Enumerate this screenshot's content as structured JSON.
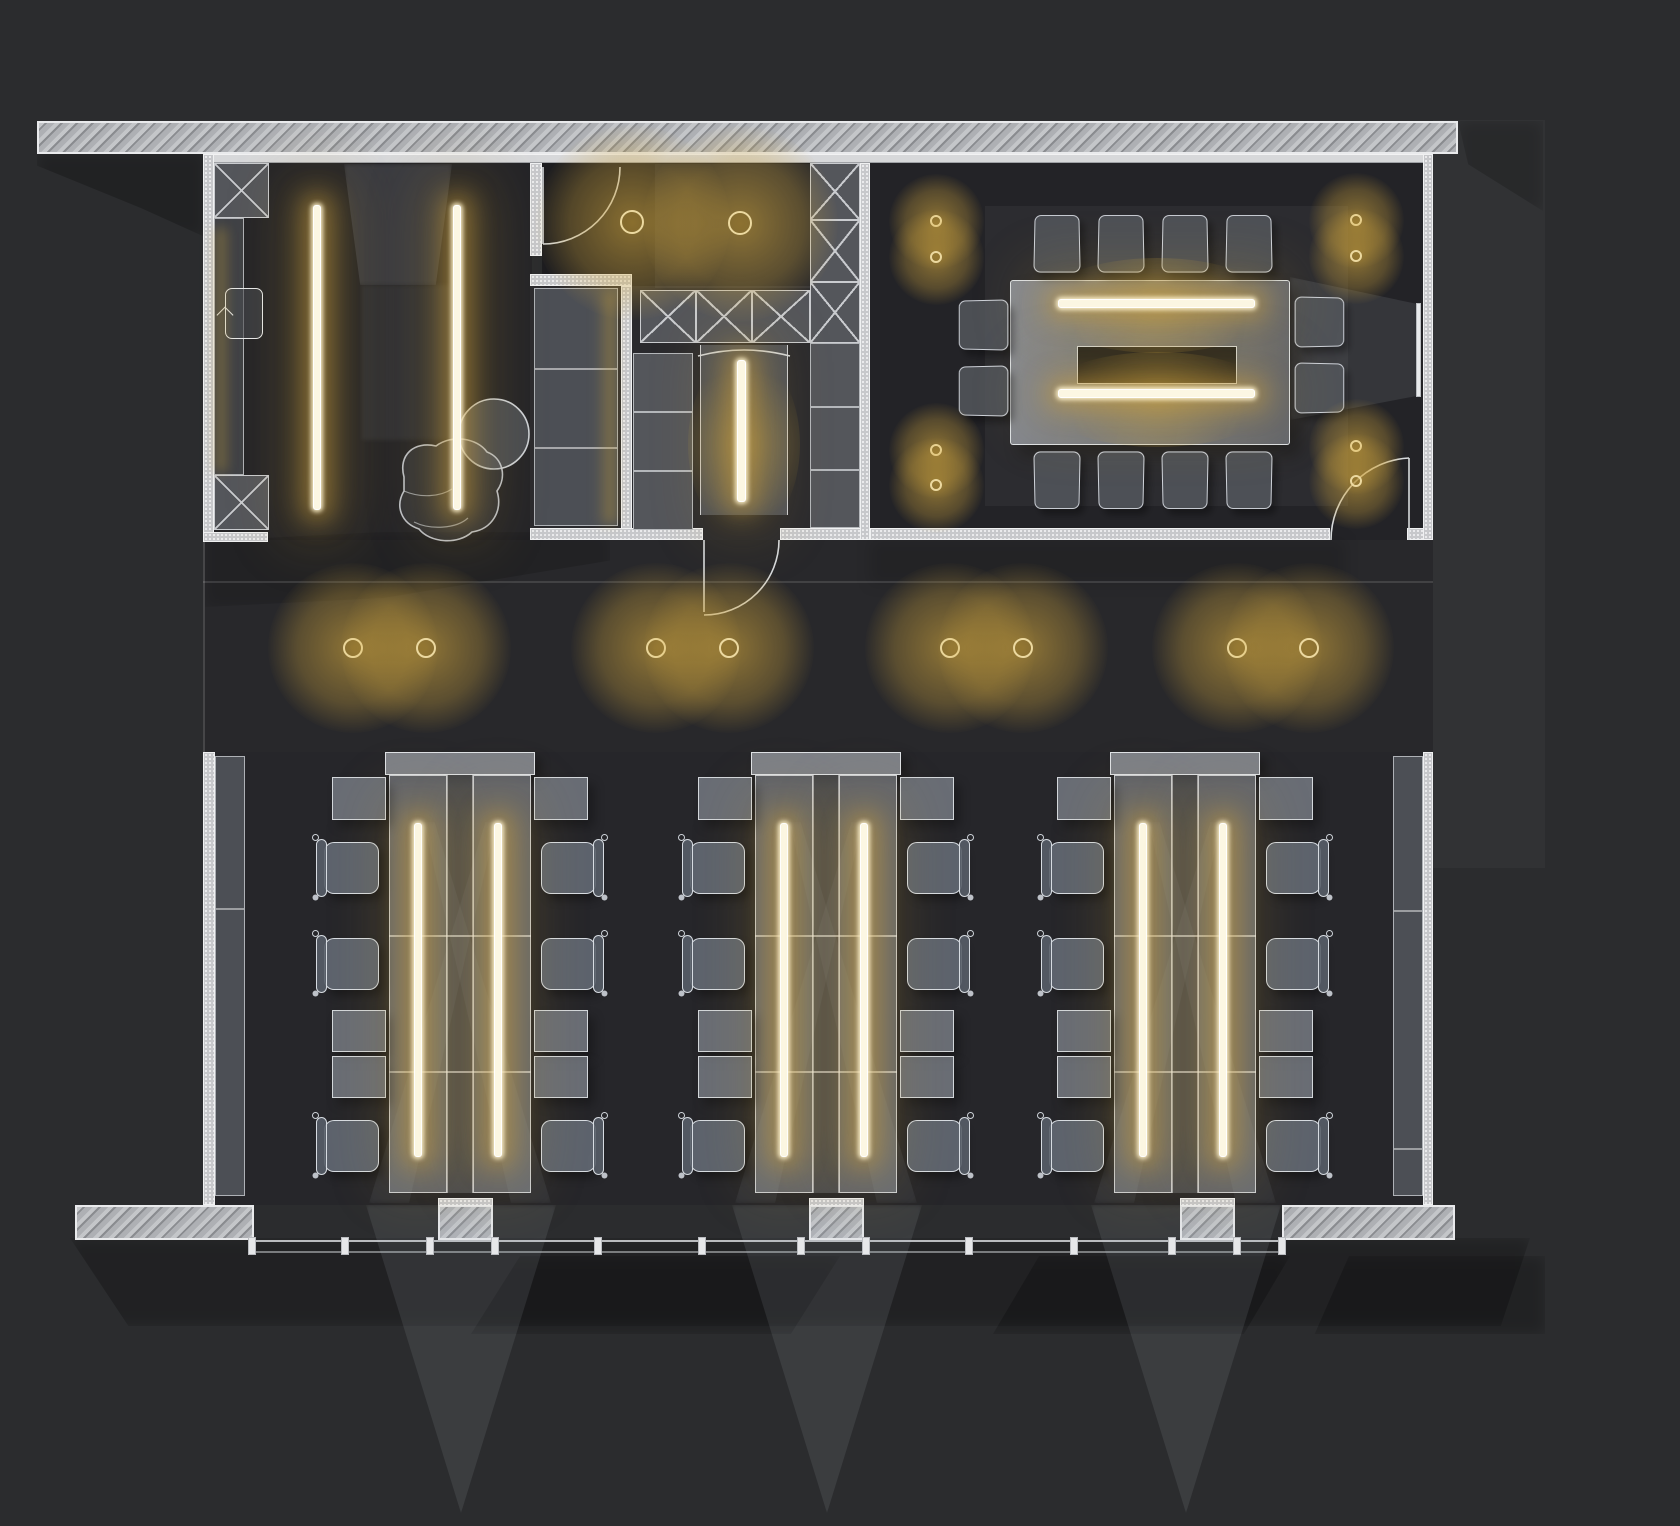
{
  "title": "office-lighting-floor-plan",
  "canvas": {
    "width": 1680,
    "height": 1526,
    "background": "#2b2c2e"
  },
  "palette": {
    "floor": "#242428",
    "floor_dark": "#1d1d20",
    "wall_hatch": "#9b9da1",
    "wall_stipple": "#c7c8cb",
    "wall_edge": "#f0f1f2",
    "furniture_fill": "rgba(172,179,191,0.5)",
    "furniture_line": "#e6eaef",
    "closet_fill": "#54565b",
    "glow_core": "#fcf7e3",
    "glow_warm": "#cfa23e",
    "halo": "rgba(210,167,62,0.6)",
    "beam": "rgba(188,198,214,0.11)",
    "shadow": "rgba(0,0,0,0.22)"
  },
  "lights": {
    "downlights": {
      "corridor": {
        "r": 10,
        "halo": 170,
        "points": [
          [
            353,
            648
          ],
          [
            426,
            648
          ],
          [
            656,
            648
          ],
          [
            729,
            648
          ],
          [
            950,
            648
          ],
          [
            1023,
            648
          ],
          [
            1237,
            648
          ],
          [
            1309,
            648
          ]
        ]
      },
      "vestibule": {
        "r": 12,
        "halo": 195,
        "points": [
          [
            632,
            222
          ],
          [
            740,
            223
          ]
        ]
      },
      "conference": {
        "r": 6,
        "halo": 95,
        "points": [
          [
            936,
            221
          ],
          [
            936,
            257
          ],
          [
            936,
            450
          ],
          [
            936,
            485
          ],
          [
            1356,
            220
          ],
          [
            1356,
            256
          ],
          [
            1356,
            446
          ],
          [
            1356,
            481
          ]
        ]
      }
    },
    "strips": [
      {
        "name": "entry-pendant-1",
        "x": 313,
        "y": 205,
        "w": 8,
        "h": 305
      },
      {
        "name": "entry-pendant-2",
        "x": 453,
        "y": 205,
        "w": 8,
        "h": 305
      },
      {
        "name": "wardrobe-niche-light",
        "x": 737,
        "y": 360,
        "w": 9,
        "h": 142
      },
      {
        "name": "conference-table-light-1",
        "x": 1058,
        "y": 299,
        "w": 197,
        "h": 9
      },
      {
        "name": "conference-table-light-2",
        "x": 1058,
        "y": 389,
        "w": 197,
        "h": 9
      }
    ],
    "edge_glows": [
      {
        "name": "entry-wardrobe-glow",
        "x": 210,
        "y": 228,
        "w": 16,
        "h": 244
      },
      {
        "name": "storage-cabinet-glow",
        "x": 596,
        "y": 292,
        "w": 20,
        "h": 232
      }
    ],
    "warm_washes": [
      {
        "x": 1040,
        "y": 258,
        "w": 235,
        "h": 95
      },
      {
        "x": 1040,
        "y": 352,
        "w": 235,
        "h": 95
      },
      {
        "x": 688,
        "y": 352,
        "w": 112,
        "h": 185
      }
    ]
  },
  "open_office": {
    "bench_xs": [
      389,
      755,
      1114
    ],
    "bench": {
      "y": 752,
      "w": 142,
      "h": 441,
      "cap_h": 23,
      "col_w": 58,
      "light_dx": [
        25,
        105
      ],
      "light_y": 823,
      "light_h": 334,
      "light_w": 8,
      "dividers_dy": [
        160,
        296
      ]
    },
    "side_rects": [
      {
        "dy": 25,
        "h": 43
      },
      {
        "dy": 258,
        "h": 42
      },
      {
        "dy": 304,
        "h": 42
      }
    ],
    "side_chairs": [
      {
        "dy": 90
      },
      {
        "dy": 186
      },
      {
        "dy": 368
      }
    ],
    "chair": {
      "w": 55,
      "h": 52
    },
    "window_beams": [
      [
        366,
        556,
        461
      ],
      [
        732,
        922,
        827
      ],
      [
        1091,
        1281,
        1186
      ]
    ]
  },
  "conference": {
    "table": {
      "x": 1010,
      "y": 280,
      "w": 280,
      "h": 165
    },
    "recess": {
      "x": 1077,
      "y": 346,
      "w": 160,
      "h": 38
    },
    "screen": {
      "x": 1416,
      "y": 303,
      "w": 5,
      "h": 94
    },
    "chairs_top_xs": [
      1034,
      1098,
      1162,
      1226
    ],
    "chairs_top_y": 214,
    "chairs_bottom_y": 452,
    "chair_tb": {
      "w": 46,
      "h": 58
    },
    "chairs_left": {
      "x": 958,
      "ys": [
        300,
        366
      ]
    },
    "chairs_right": {
      "x": 1295,
      "ys": [
        297,
        363
      ]
    },
    "chair_lr": {
      "w": 50,
      "h": 50
    }
  },
  "windows": {
    "sill_y": 1240,
    "mullion_xs": [
      252,
      345,
      430,
      495,
      598,
      702,
      801,
      866,
      969,
      1074,
      1172,
      1237,
      1282
    ]
  },
  "icons": [
    {
      "name": "entry-door-symbol",
      "x": 225,
      "y": 288,
      "w": 38,
      "h": 51
    }
  ]
}
